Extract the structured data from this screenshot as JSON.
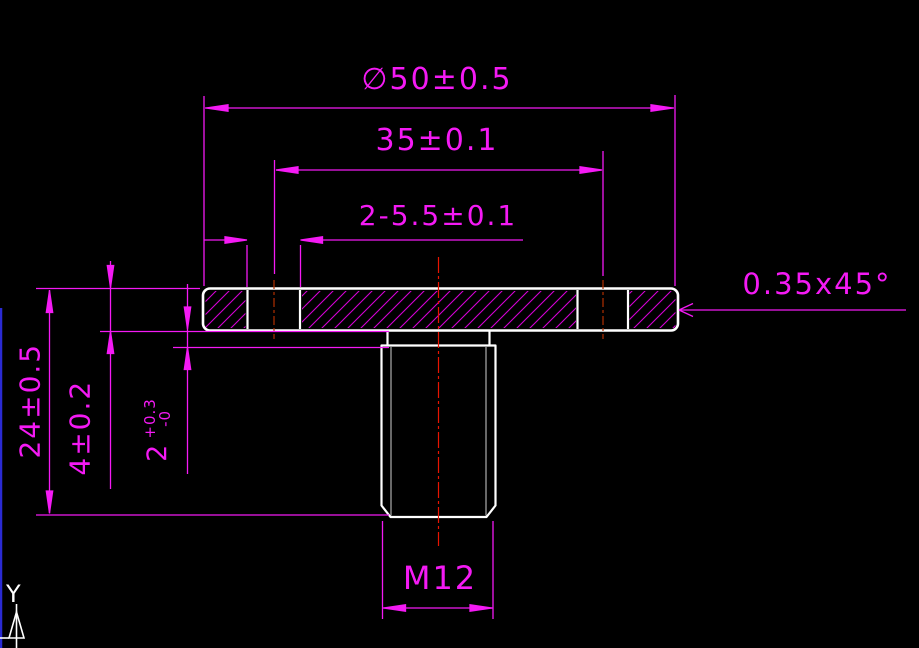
{
  "drawing": {
    "dimension_labels": {
      "flange_diameter": "∅50±0.5",
      "hole_spacing": "35±0.1",
      "holes": "2-5.5±0.1",
      "chamfer": "0.35x45°",
      "total_height": "24±0.5",
      "flange_thickness": "4±0.2",
      "boss_height": "2",
      "boss_tol_upper": "+0.3",
      "boss_tol_lower": "-0",
      "thread": "M12"
    },
    "ucs": {
      "y_axis_label": "Y"
    },
    "colors": {
      "background": "#000000",
      "dimension_magenta": "#f41af4",
      "part_outline_white": "#ffffff",
      "centerline_red": "#e81400",
      "hatch_magenta": "#d400d4",
      "frame_blue": "#2a2ad2"
    }
  }
}
